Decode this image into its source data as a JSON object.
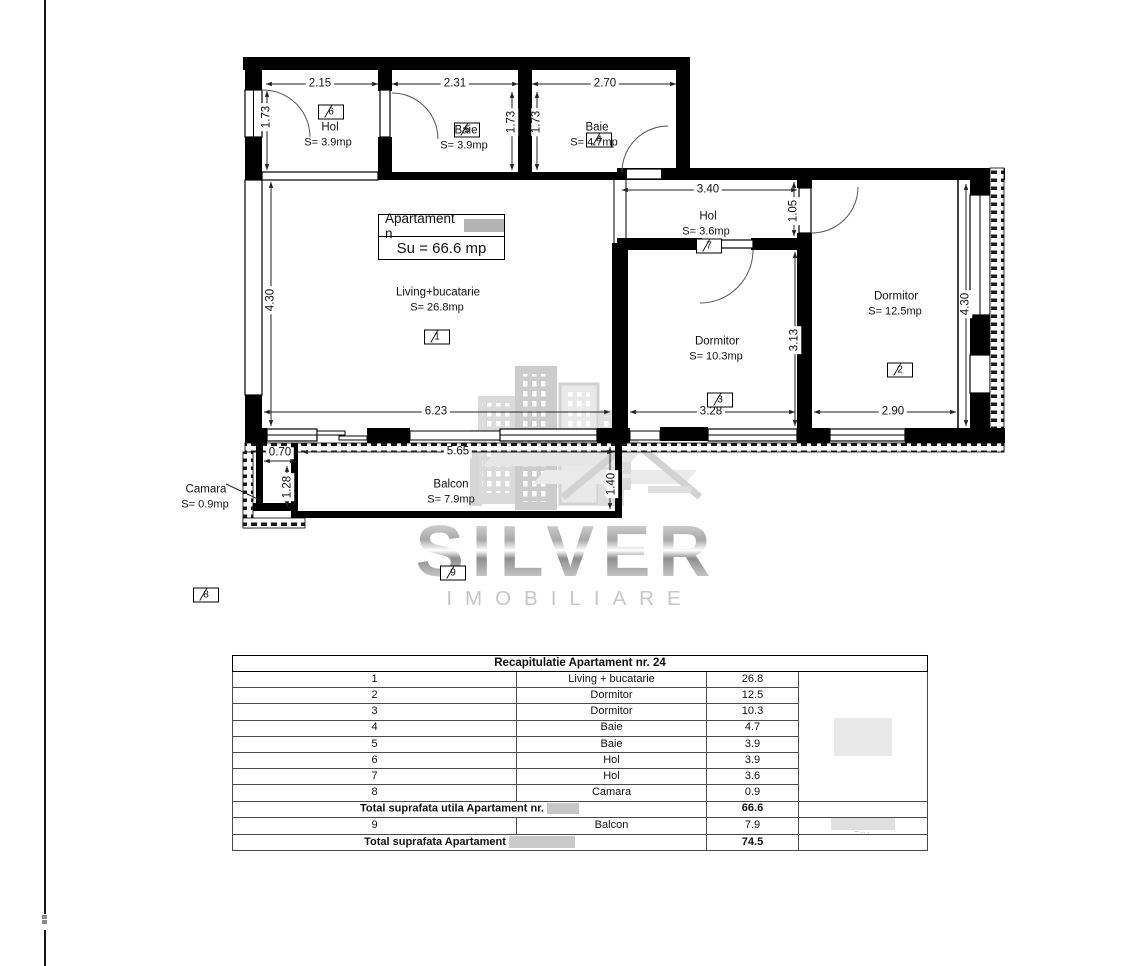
{
  "plan": {
    "apartment_box": {
      "title": "Apartament n",
      "su": "Su = 66.6 mp"
    },
    "rooms": [
      {
        "num": "1",
        "name": "Living+bucatarie",
        "area": "S= 26.8mp"
      },
      {
        "num": "2",
        "name": "Dormitor",
        "area": "S= 12.5mp"
      },
      {
        "num": "3",
        "name": "Dormitor",
        "area": "S= 10.3mp"
      },
      {
        "num": "4",
        "name": "Baie",
        "area": "S= 4.7mp"
      },
      {
        "num": "5",
        "name": "Baie",
        "area": "S= 3.9mp"
      },
      {
        "num": "6",
        "name": "Hol",
        "area": "S= 3.9mp"
      },
      {
        "num": "7",
        "name": "Hol",
        "area": "S= 3.6mp"
      },
      {
        "num": "8",
        "name": "Camara",
        "area": "S= 0.9mp"
      },
      {
        "num": "9",
        "name": "Balcon",
        "area": "S= 7.9mp"
      }
    ],
    "dims": {
      "d215": "2.15",
      "d231": "2.31",
      "d270": "2.70",
      "d173": "1.73",
      "d340": "3.40",
      "d105": "1.05",
      "d430": "4.30",
      "d313": "3.13",
      "d623": "6.23",
      "d328": "3.28",
      "d290": "2.90",
      "d565": "5.65",
      "d140": "1.40",
      "d070": "0.70",
      "d128": "1.28"
    }
  },
  "watermark": {
    "line1": "SILVER",
    "line2": "IMOBILIARE"
  },
  "table": {
    "title": "Recapitulatie Apartament nr. 24",
    "rows": [
      {
        "no": "1",
        "name": "Living + bucatarie",
        "area": "26.8"
      },
      {
        "no": "2",
        "name": "Dormitor",
        "area": "12.5"
      },
      {
        "no": "3",
        "name": "Dormitor",
        "area": "10.3"
      },
      {
        "no": "4",
        "name": "Baie",
        "area": "4.7"
      },
      {
        "no": "5",
        "name": "Baie",
        "area": "3.9"
      },
      {
        "no": "6",
        "name": "Hol",
        "area": "3.9"
      },
      {
        "no": "7",
        "name": "Hol",
        "area": "3.6"
      },
      {
        "no": "8",
        "name": "Camara",
        "area": "0.9"
      }
    ],
    "total_utila": {
      "label": "Total suprafata utila Apartament nr.",
      "value": "66.6"
    },
    "balcon_row": {
      "no": "9",
      "name": "Balcon",
      "area": "7.9"
    },
    "total": {
      "label": "Total suprafata Apartament",
      "value": "74.5"
    }
  }
}
